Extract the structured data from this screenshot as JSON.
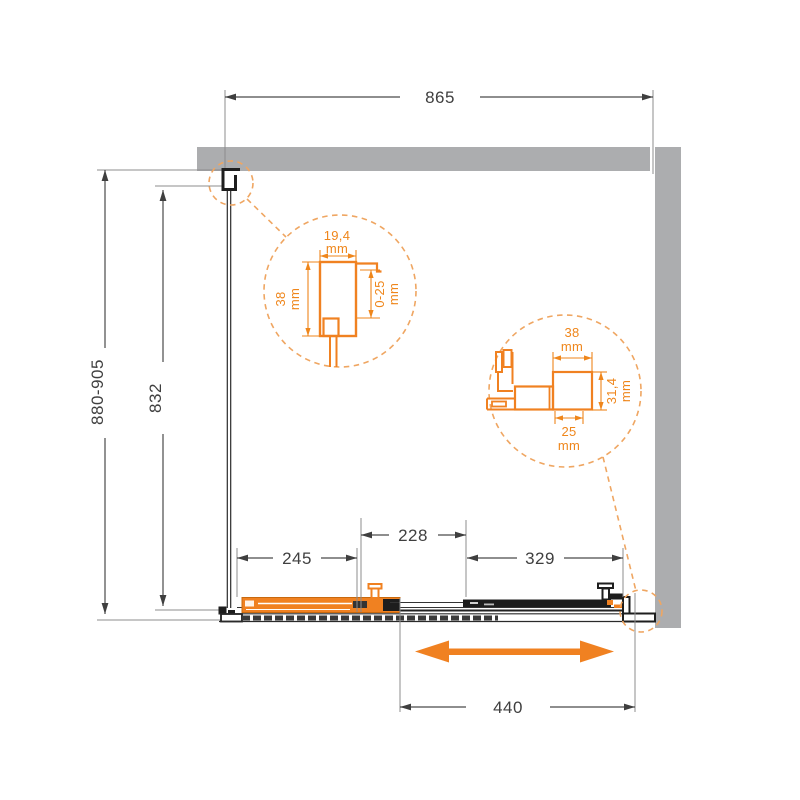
{
  "dims": {
    "width": "865",
    "height_range": "880-905",
    "glass_height": "832",
    "fixed_panel": "245",
    "overlap": "228",
    "door_section": "329",
    "opening": "440"
  },
  "detail_top": {
    "profile_width": {
      "value": "19,4",
      "unit": "mm"
    },
    "profile_depth": {
      "value": "38",
      "unit": "mm"
    },
    "adjustment_range": {
      "value": "0-25",
      "unit": "mm"
    }
  },
  "detail_bottom": {
    "rail_width": {
      "value": "38",
      "unit": "mm"
    },
    "glass_offset": {
      "value": "25",
      "unit": "mm"
    },
    "rail_height": {
      "value": "31,4",
      "unit": "mm"
    }
  },
  "colors": {
    "accent_orange": "#F08121",
    "detail_dash_orange": "#EFA662",
    "wall_gray": "#ACADAF",
    "line_dark": "#3F3F3F"
  }
}
